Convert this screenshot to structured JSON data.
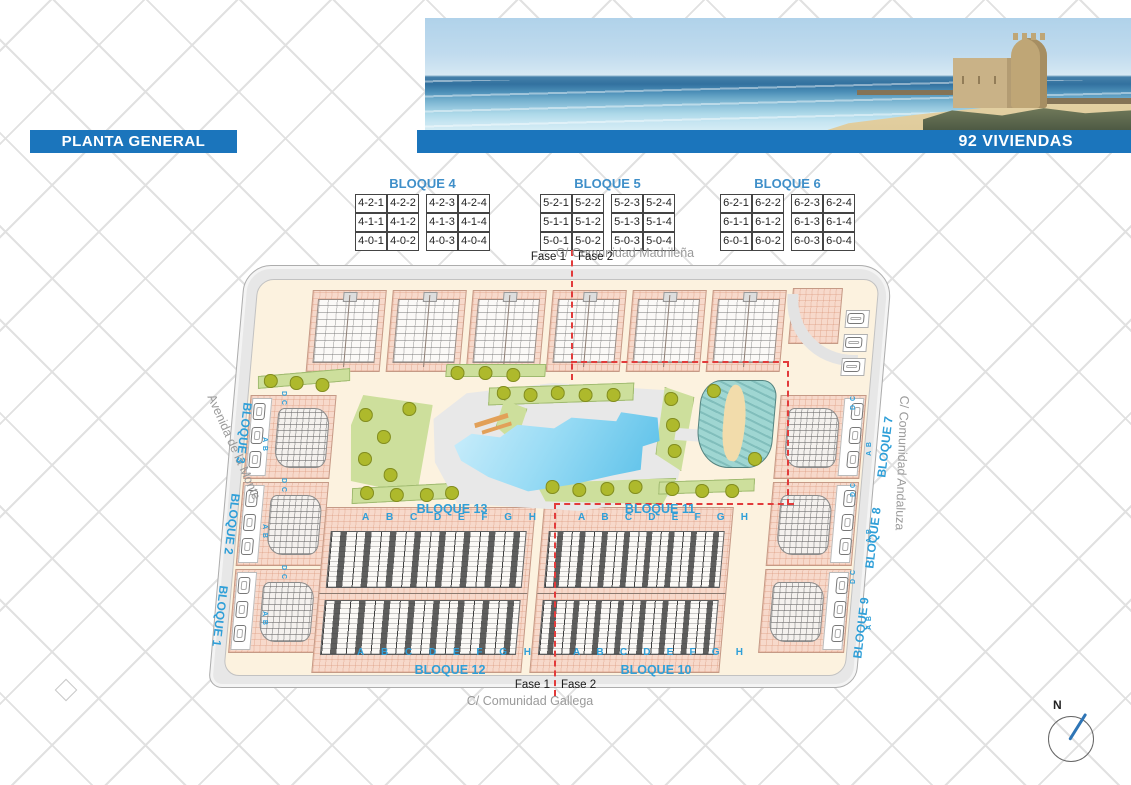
{
  "header": {
    "title": "PLANTA GENERAL",
    "units_banner": "92 VIVIENDAS"
  },
  "unit_tables": [
    {
      "title": "BLOQUE 4",
      "rows": [
        [
          "4-2-1",
          "4-2-2",
          "4-2-3",
          "4-2-4"
        ],
        [
          "4-1-1",
          "4-1-2",
          "4-1-3",
          "4-1-4"
        ],
        [
          "4-0-1",
          "4-0-2",
          "4-0-3",
          "4-0-4"
        ]
      ]
    },
    {
      "title": "BLOQUE 5",
      "rows": [
        [
          "5-2-1",
          "5-2-2",
          "5-2-3",
          "5-2-4"
        ],
        [
          "5-1-1",
          "5-1-2",
          "5-1-3",
          "5-1-4"
        ],
        [
          "5-0-1",
          "5-0-2",
          "5-0-3",
          "5-0-4"
        ]
      ]
    },
    {
      "title": "BLOQUE 6",
      "rows": [
        [
          "6-2-1",
          "6-2-2",
          "6-2-3",
          "6-2-4"
        ],
        [
          "6-1-1",
          "6-1-2",
          "6-1-3",
          "6-1-4"
        ],
        [
          "6-0-1",
          "6-0-2",
          "6-0-3",
          "6-0-4"
        ]
      ]
    }
  ],
  "streets": {
    "top": "C/ Comunidad Madrileña",
    "bottom": "C/ Comunidad Gallega",
    "left": "Avenida de la Monte",
    "right": "C/ Comunidad Andaluza"
  },
  "phases": {
    "fase1": "Fase 1",
    "fase2": "Fase 2"
  },
  "plan_blocks": {
    "left": [
      "BLOQUE 3",
      "BLOQUE 2",
      "BLOQUE 1"
    ],
    "right": [
      "BLOQUE 7",
      "BLOQUE 8",
      "BLOQUE 9"
    ],
    "center_top": [
      "BLOQUE 13",
      "BLOQUE 11"
    ],
    "center_bottom": [
      "BLOQUE 12",
      "BLOQUE 10"
    ],
    "row_letters": [
      "A",
      "B",
      "C",
      "D",
      "E",
      "F",
      "G",
      "H"
    ],
    "unit_pair_labels": [
      "D C",
      "A B"
    ]
  },
  "compass": {
    "label": "N"
  },
  "colors": {
    "banner_blue": "#1b75bc",
    "label_blue": "#2f9fd8",
    "phase_red": "#e23b3b",
    "building_salmon": "#f7d9cb",
    "pool_blue": "#58bfe8",
    "grass_green": "#cddf9c",
    "tree_olive": "#aeb92c",
    "road_gray": "#e7e7e7",
    "water_teal": "#9fd6d2"
  }
}
